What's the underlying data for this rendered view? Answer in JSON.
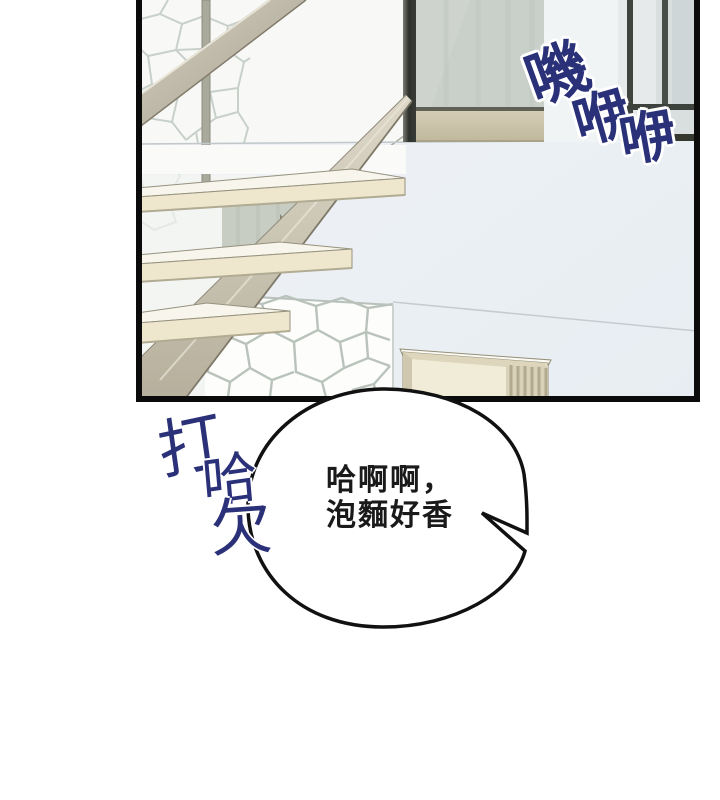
{
  "comic": {
    "sfx_creak": {
      "char1": "嘰",
      "char2": "咿",
      "char3": "咿"
    },
    "sfx_yawn": {
      "char1": "打",
      "char2": "哈",
      "char3": "欠"
    },
    "speech": {
      "line1": "哈啊啊，",
      "line2": "泡麵好香"
    }
  },
  "colors": {
    "sfx_ink": "#2b3178",
    "speech_text": "#1a1a1a",
    "bubble_outline": "#111111",
    "panel_border": "#0b0b0b",
    "step_cream": "#eee7cd",
    "stone_joint": "#c3ccc5",
    "glass_gray": "#c9cfc9",
    "wall_light_blue": "#edf1f5"
  }
}
